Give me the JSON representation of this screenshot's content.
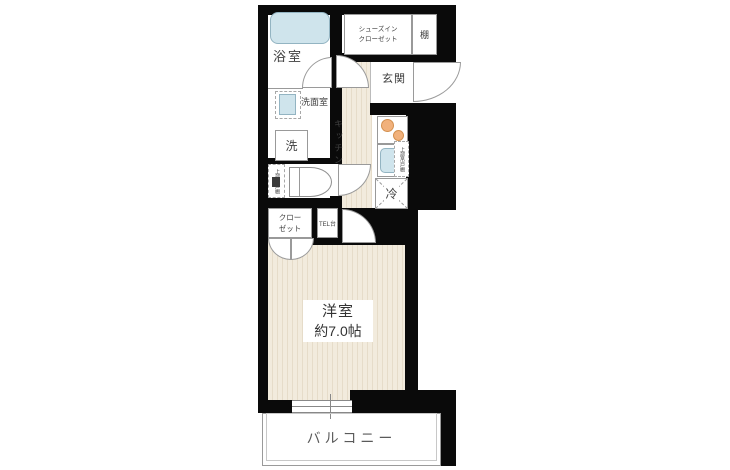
{
  "plan": {
    "type": "floorplan",
    "rooms": {
      "bathroom": {
        "label": "浴室"
      },
      "shoe_in_closet": {
        "label_line1": "シューズイン",
        "label_line2": "クローゼット"
      },
      "shelf": {
        "label": "棚"
      },
      "entrance": {
        "label": "玄関"
      },
      "washroom": {
        "label": "洗面室"
      },
      "washing_machine": {
        "label": "洗"
      },
      "toilet_upper_cabinet": {
        "label": "上部吊戸棚"
      },
      "kitchen": {
        "label": "キッチン"
      },
      "kitchen_upper_cabinet": {
        "label": "上部吊戸棚"
      },
      "refrigerator": {
        "label": "冷"
      },
      "closet": {
        "label_line1": "クロー",
        "label_line2": "ゼット"
      },
      "tel_stand": {
        "label": "TEL台"
      },
      "western_room": {
        "label": "洋室",
        "size": "約7.0帖"
      },
      "balcony": {
        "label": "バルコニー"
      }
    },
    "colors": {
      "wall": "#0a0a0a",
      "floor_base": "#f2ebdd",
      "floor_stripe": "#e6dcc9",
      "water_fill": "#cfe4ec",
      "water_edge": "#93b4c2",
      "burner_fill": "#f1b17c",
      "burner_edge": "#d3904f",
      "line": "#999999",
      "text": "#3f3f3f"
    }
  }
}
